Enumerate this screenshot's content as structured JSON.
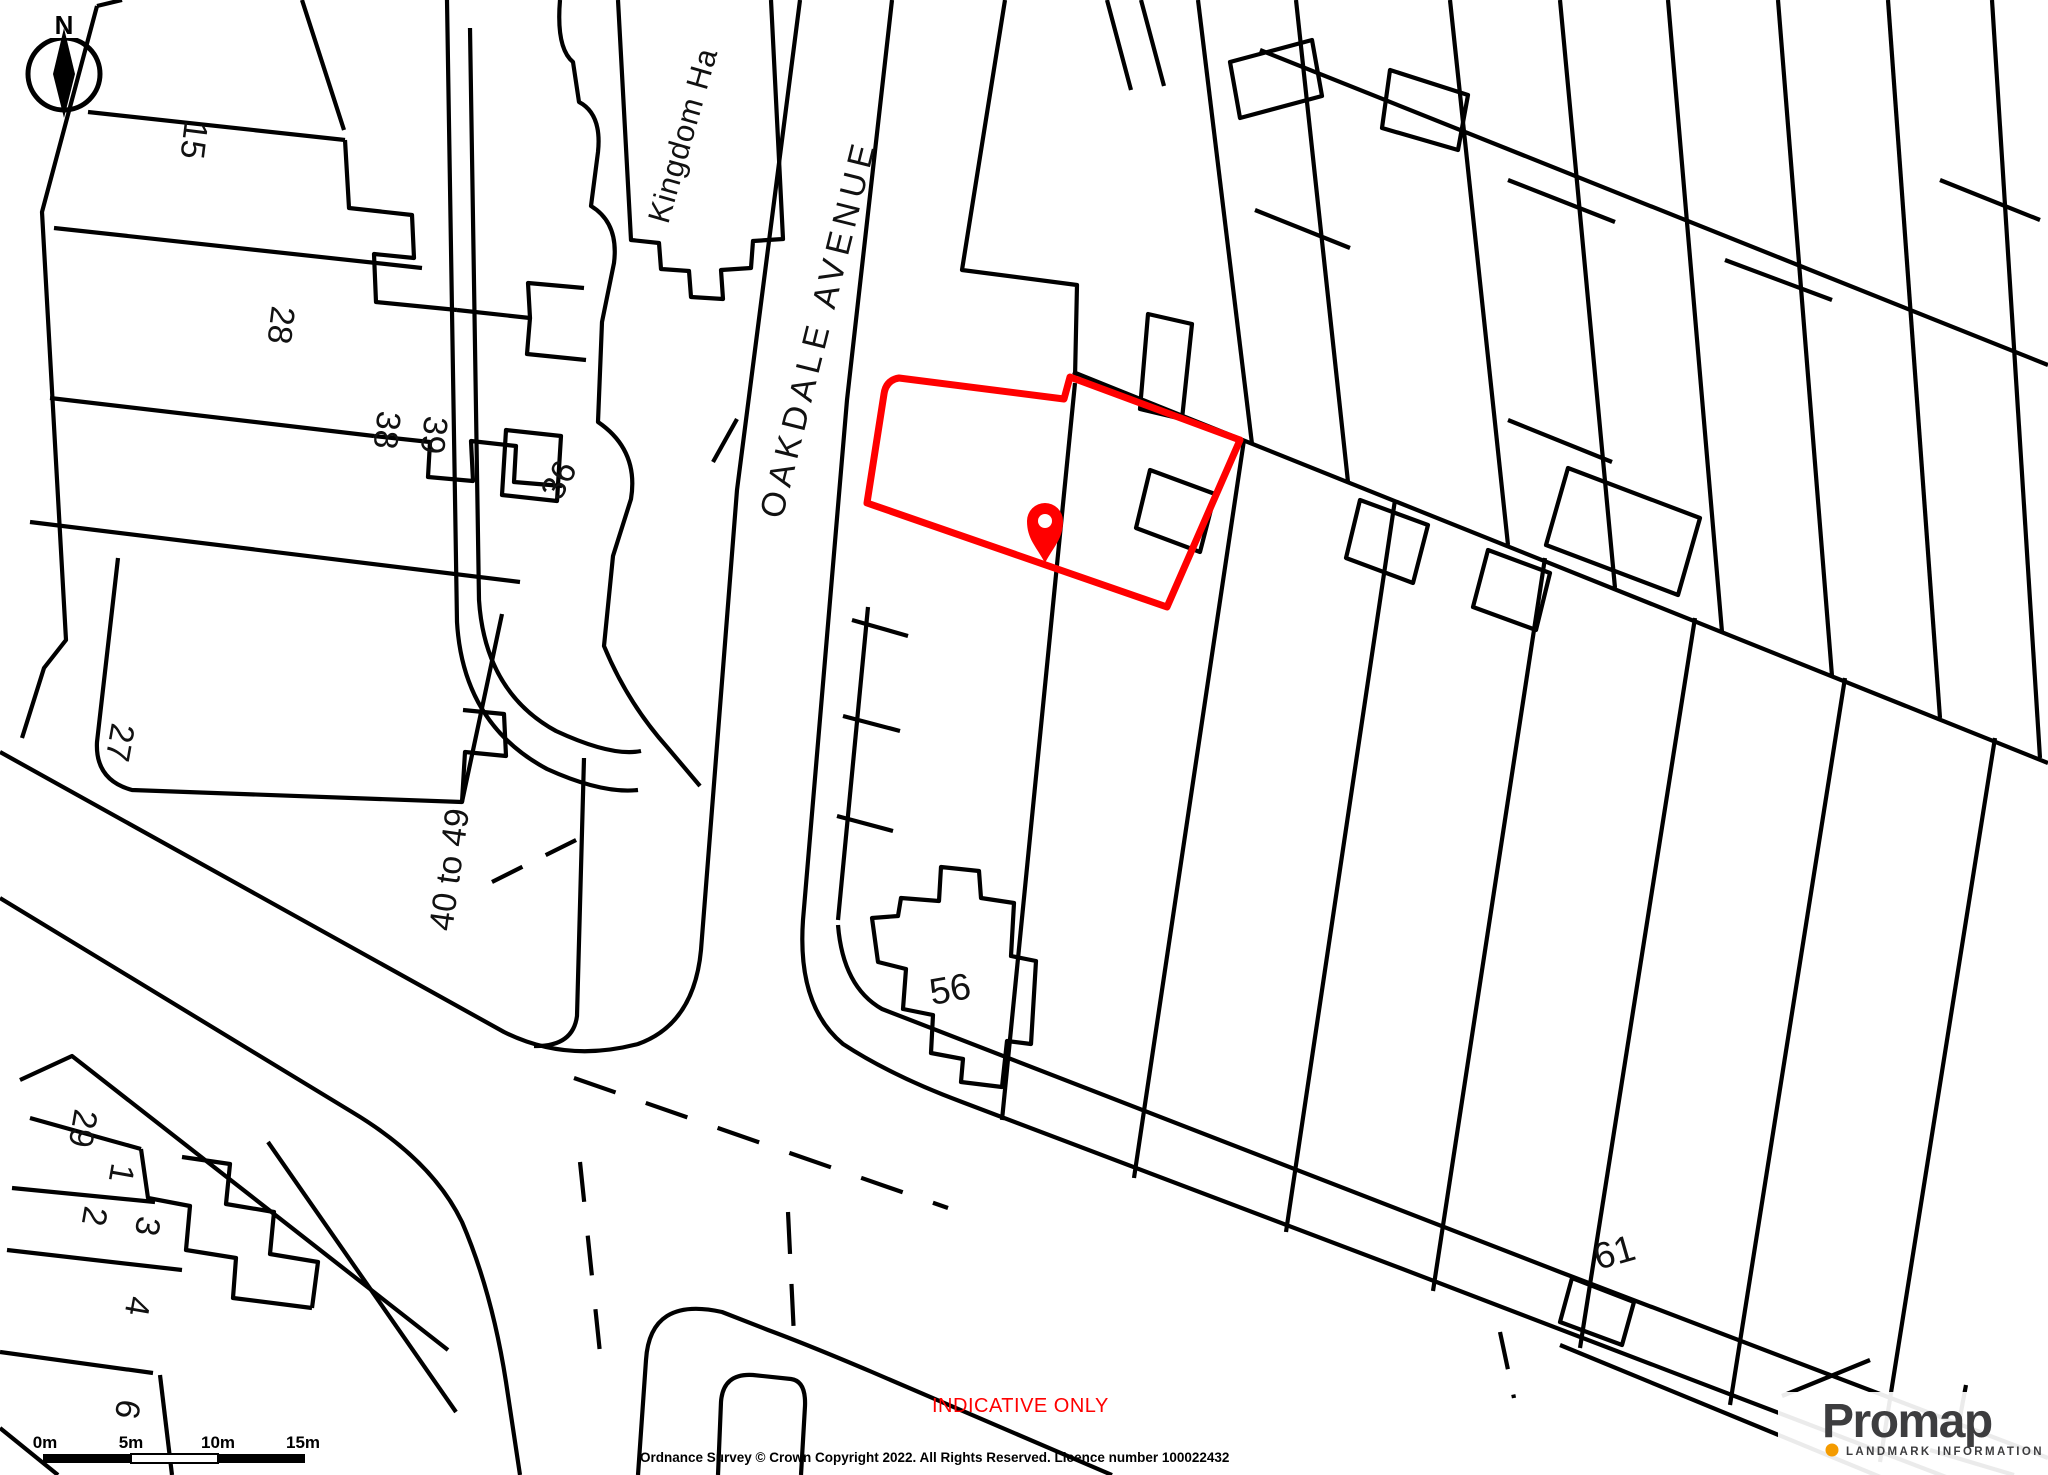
{
  "labels": {
    "street": "OAKDALE AVENUE",
    "kingdom_hall": "Kingdom Ha",
    "n15": "15",
    "n28": "28",
    "n38": "38",
    "n39": "39",
    "n36": "36",
    "n27": "27",
    "n40_49": "40 to 49",
    "n29": "29",
    "n1": "1",
    "n2": "2",
    "n3": "3",
    "n4": "4",
    "n6": "6",
    "n56": "56",
    "n61": "61"
  },
  "compass": {
    "north": "N"
  },
  "scale_bar": {
    "t0": "0m",
    "t5": "5m",
    "t10": "10m",
    "t15": "15m"
  },
  "watermark": {
    "indicative": "INDICATIVE ONLY"
  },
  "footer": {
    "copyright": "Ordnance Survey © Crown Copyright 2022. All Rights Reserved. Licence number 100022432"
  },
  "logo": {
    "brand": "Promap",
    "tagline": "LANDMARK INFORMATION"
  },
  "colors": {
    "map_line": "#000000",
    "plot_outline": "#ff0000",
    "pin": "#ff0000",
    "indicative_text": "#ff0000",
    "logo_text": "#3d3d3f",
    "logo_dot": "#f49b00"
  }
}
